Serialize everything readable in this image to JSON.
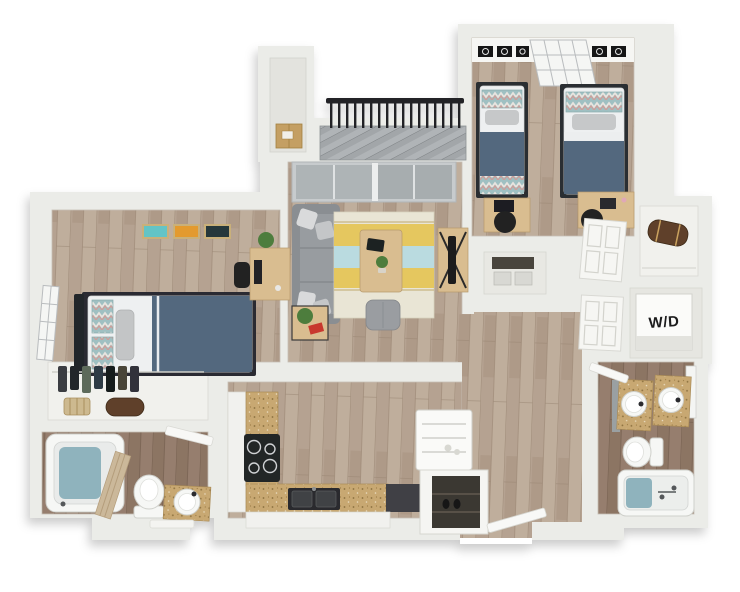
{
  "image_type": "3d-isometric-floor-plan",
  "labels": {
    "washer_dryer": "W/D"
  },
  "colors": {
    "wall": "#ebece8",
    "wall_face": "#f6f6f3",
    "floor_light": "#b5a291",
    "floor_dark": "#8c7464",
    "deck": "#a2a6a9",
    "railing": "#212326",
    "sofa": "#8a8e92",
    "bedding": "#52687e",
    "rug_cream": "#e9e5d5",
    "rug_yellow": "#e5c75e",
    "rug_blue": "#badbe0",
    "counter": "#c8a872",
    "water": "#8fb3bd",
    "appliance_dark": "#242527",
    "wood_furniture": "#d9bd90",
    "art_teal": "#63c4c6",
    "art_orange": "#e39a2d",
    "art_dark": "#27393b",
    "plant": "#4e7d3e",
    "accent_red": "#c8372d",
    "cardboard_box": "#c49f63",
    "duffel": "#5f4129"
  },
  "rooms": [
    {
      "name": "bedroom-1",
      "furniture": [
        "twin-bed",
        "desk",
        "chair",
        "plant",
        "window",
        "wall-art-teal",
        "wall-art-orange",
        "wall-art-dark"
      ]
    },
    {
      "name": "bedroom-1-closet",
      "furniture": [
        "hanging-clothes",
        "basket",
        "duffel-bag"
      ]
    },
    {
      "name": "bathroom-1",
      "furniture": [
        "bathtub",
        "shower-curtain",
        "toilet",
        "vanity-sink",
        "bath-mat",
        "door"
      ]
    },
    {
      "name": "kitchen",
      "furniture": [
        "cooktop",
        "double-sink",
        "counters",
        "cabinets",
        "refrigerator",
        "pantry"
      ]
    },
    {
      "name": "living-room",
      "furniture": [
        "sectional-sofa",
        "striped-rug",
        "coffee-table",
        "tablet",
        "ottoman",
        "side-table",
        "tv-console",
        "sliding-glass-door"
      ]
    },
    {
      "name": "balcony",
      "furniture": [
        "railing",
        "deck"
      ]
    },
    {
      "name": "storage-closet",
      "furniture": [
        "cardboard-box"
      ]
    },
    {
      "name": "bedroom-2",
      "furniture": [
        "twin-bed",
        "twin-bed",
        "window",
        "wall-art-frames",
        "desk",
        "desk",
        "chairs"
      ]
    },
    {
      "name": "hall-closet",
      "furniture": [
        "storage-boxes",
        "paneled-closet-doors"
      ]
    },
    {
      "name": "wing-closet",
      "furniture": [
        "duffel-bag"
      ]
    },
    {
      "name": "laundry-closet",
      "furniture": [
        "washer-dryer-unit"
      ]
    },
    {
      "name": "bathroom-2",
      "furniture": [
        "double-vanity",
        "toilet",
        "bathtub",
        "mirror",
        "door"
      ]
    },
    {
      "name": "entry",
      "furniture": [
        "door"
      ]
    }
  ]
}
